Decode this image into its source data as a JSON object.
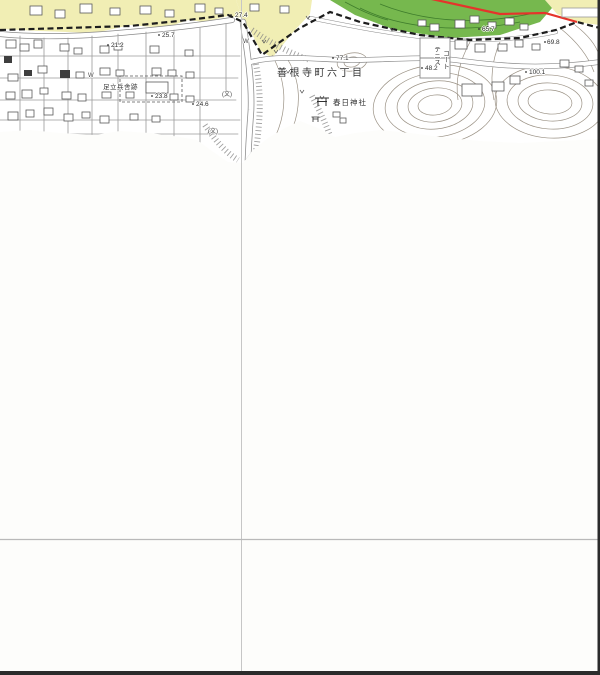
{
  "map": {
    "type": "japanese-topographic-map-tile-partially-loaded",
    "place_labels": [
      {
        "name": "district-label",
        "text": "善根寺町六丁目",
        "x": 277,
        "y": 69,
        "size": 10,
        "spacing": 2.5,
        "vertical": false
      },
      {
        "name": "shrine-label",
        "text": "春日神社",
        "x": 333,
        "y": 99,
        "size": 7.5,
        "spacing": 1,
        "vertical": false
      },
      {
        "name": "site-label",
        "text": "足立兵舎跡",
        "x": 103,
        "y": 85,
        "size": 6.5,
        "spacing": 0.5,
        "vertical": false
      },
      {
        "name": "tennis-label-col1",
        "text": "テニス",
        "x": 432,
        "y": 46,
        "size": 6.5,
        "spacing": 0,
        "vertical": true
      },
      {
        "name": "tennis-label-col2",
        "text": "コート",
        "x": 441,
        "y": 50,
        "size": 6.5,
        "spacing": 0,
        "vertical": true
      }
    ],
    "elevation_labels": [
      {
        "text": "27.4",
        "x": 235,
        "y": 13
      },
      {
        "text": "21.2",
        "x": 111,
        "y": 43
      },
      {
        "text": "25.7",
        "x": 162,
        "y": 33
      },
      {
        "text": "24.6",
        "x": 196,
        "y": 102
      },
      {
        "text": "23.8",
        "x": 155,
        "y": 94
      },
      {
        "text": "77.1",
        "x": 336,
        "y": 56
      },
      {
        "text": "48.2",
        "x": 425,
        "y": 66
      },
      {
        "text": "65.7",
        "x": 482,
        "y": 27
      },
      {
        "text": "69.8",
        "x": 547,
        "y": 40
      },
      {
        "text": "100.1",
        "x": 529,
        "y": 70
      }
    ],
    "symbol_labels": [
      {
        "text": "W",
        "x": 243,
        "y": 39,
        "meaning": "water-supply-mark"
      },
      {
        "text": "W",
        "x": 88,
        "y": 73,
        "meaning": "water-supply-mark"
      },
      {
        "text": "(文)",
        "x": 222,
        "y": 92,
        "meaning": "high-school-symbol"
      },
      {
        "text": "(文)",
        "x": 208,
        "y": 129,
        "meaning": "high-school-symbol"
      }
    ],
    "icons": [
      {
        "name": "torii-shrine-icon",
        "x": 322,
        "y": 100
      },
      {
        "name": "torii-shrine-icon-small",
        "x": 315,
        "y": 117
      }
    ],
    "colors": {
      "land_yellow": "#f1eeb4",
      "forest_green": "#76b84e",
      "forest_contour": "#3f7d2c",
      "boundary_red": "#e5342b",
      "contour": "#9a9184",
      "road_casing": "#8a8a8a",
      "building_line": "#5a5a5a",
      "ink": "#303030",
      "grid_line": "#c6c6c6",
      "border_dark": "#2b2b2b",
      "bg": "#fdfdfb"
    },
    "grid": {
      "vertical_line_x": 242,
      "horizontal_line_y": 540,
      "right_border_x": 598,
      "bottom_border_y": 671
    }
  }
}
